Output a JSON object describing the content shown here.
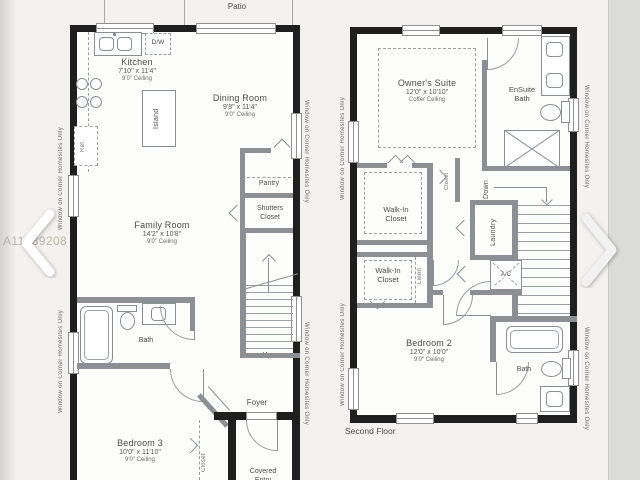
{
  "shared": {
    "window_note": "Window on Corner Homesites Only",
    "watermark": "A11439208 © Miami MLS® 2023"
  },
  "nav": {
    "prev_icon": "chevron-left",
    "next_icon": "chevron-right"
  },
  "colors": {
    "wall": "#1f1f1f",
    "interior_wall": "#8c9094",
    "sheet": "#f4f2ee",
    "label": "#4b4b4b",
    "watermark": "#b2aea6"
  },
  "floor1": {
    "patio": "Patio",
    "kitchen": {
      "name": "Kitchen",
      "dims": "7'10\" x 11'4\"",
      "ceiling": "9'0\" Ceiling"
    },
    "dining": {
      "name": "Dining Room",
      "dims": "9'8\" x 11'4\"",
      "ceiling": "9'0\" Ceiling"
    },
    "family": {
      "name": "Family Room",
      "dims": "14'2\" x 10'8\"",
      "ceiling": "9'0\" Ceiling"
    },
    "bedroom3": {
      "name": "Bedroom 3",
      "dims": "10'0\" x 11'10\"",
      "ceiling": "9'0\" Ceiling"
    },
    "labels": {
      "dw": "D/W",
      "island": "Island",
      "ref": "Ref.",
      "pantry": "Pantry",
      "shutters": "Shutters Closet",
      "bath": "Bath",
      "up": "Up",
      "foyer": "Foyer",
      "closet": "Closet",
      "covered": "Covered Entry"
    }
  },
  "floor2": {
    "owners": {
      "name": "Owner's Suite",
      "dims": "12'0\" x 10'10\"",
      "ceiling": "Coffer Ceiling"
    },
    "bedroom2": {
      "name": "Bedroom 2",
      "dims": "12'0\" x 10'0\"",
      "ceiling": "9'0\" Ceiling"
    },
    "labels": {
      "ensuite": "EnSuite Bath",
      "walkin": "Walk-In Closet",
      "linen": "Linen",
      "closet": "Closet",
      "down": "Down",
      "laundry": "Laundry",
      "ac": "A/C",
      "bath": "Bath",
      "floor": "Second Floor"
    }
  }
}
